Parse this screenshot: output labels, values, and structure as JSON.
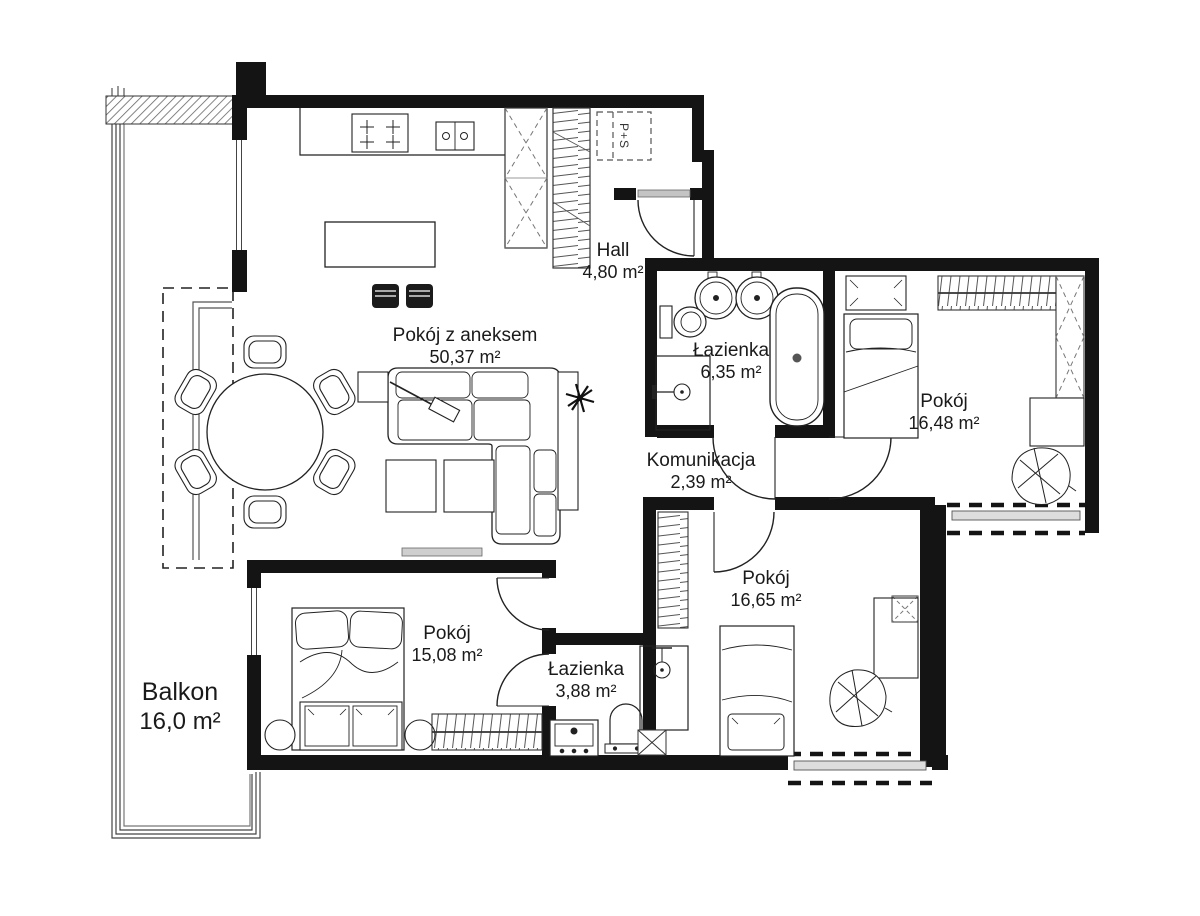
{
  "plan": {
    "rooms": [
      {
        "id": "living",
        "name": "Pokój z aneksem",
        "area": "50,37 m²"
      },
      {
        "id": "hall",
        "name": "Hall",
        "area": "4,80 m²"
      },
      {
        "id": "bath1",
        "name": "Łazienka",
        "area": "6,35 m²"
      },
      {
        "id": "bed1",
        "name": "Pokój",
        "area": "16,48 m²"
      },
      {
        "id": "komunikacja",
        "name": "Komunikacja",
        "area": "2,39 m²"
      },
      {
        "id": "bed2",
        "name": "Pokój",
        "area": "16,65 m²"
      },
      {
        "id": "bed3",
        "name": "Pokój",
        "area": "15,08 m²"
      },
      {
        "id": "bath2",
        "name": "Łazienka",
        "area": "3,88 m²"
      },
      {
        "id": "balkon",
        "name": "Balkon",
        "area": "16,0 m²"
      }
    ],
    "annotations": {
      "washer_dryer": "P+S"
    },
    "colors": {
      "wall": "#141414",
      "line": "#222222",
      "muted": "#c4c4c4",
      "background": "#ffffff"
    }
  }
}
